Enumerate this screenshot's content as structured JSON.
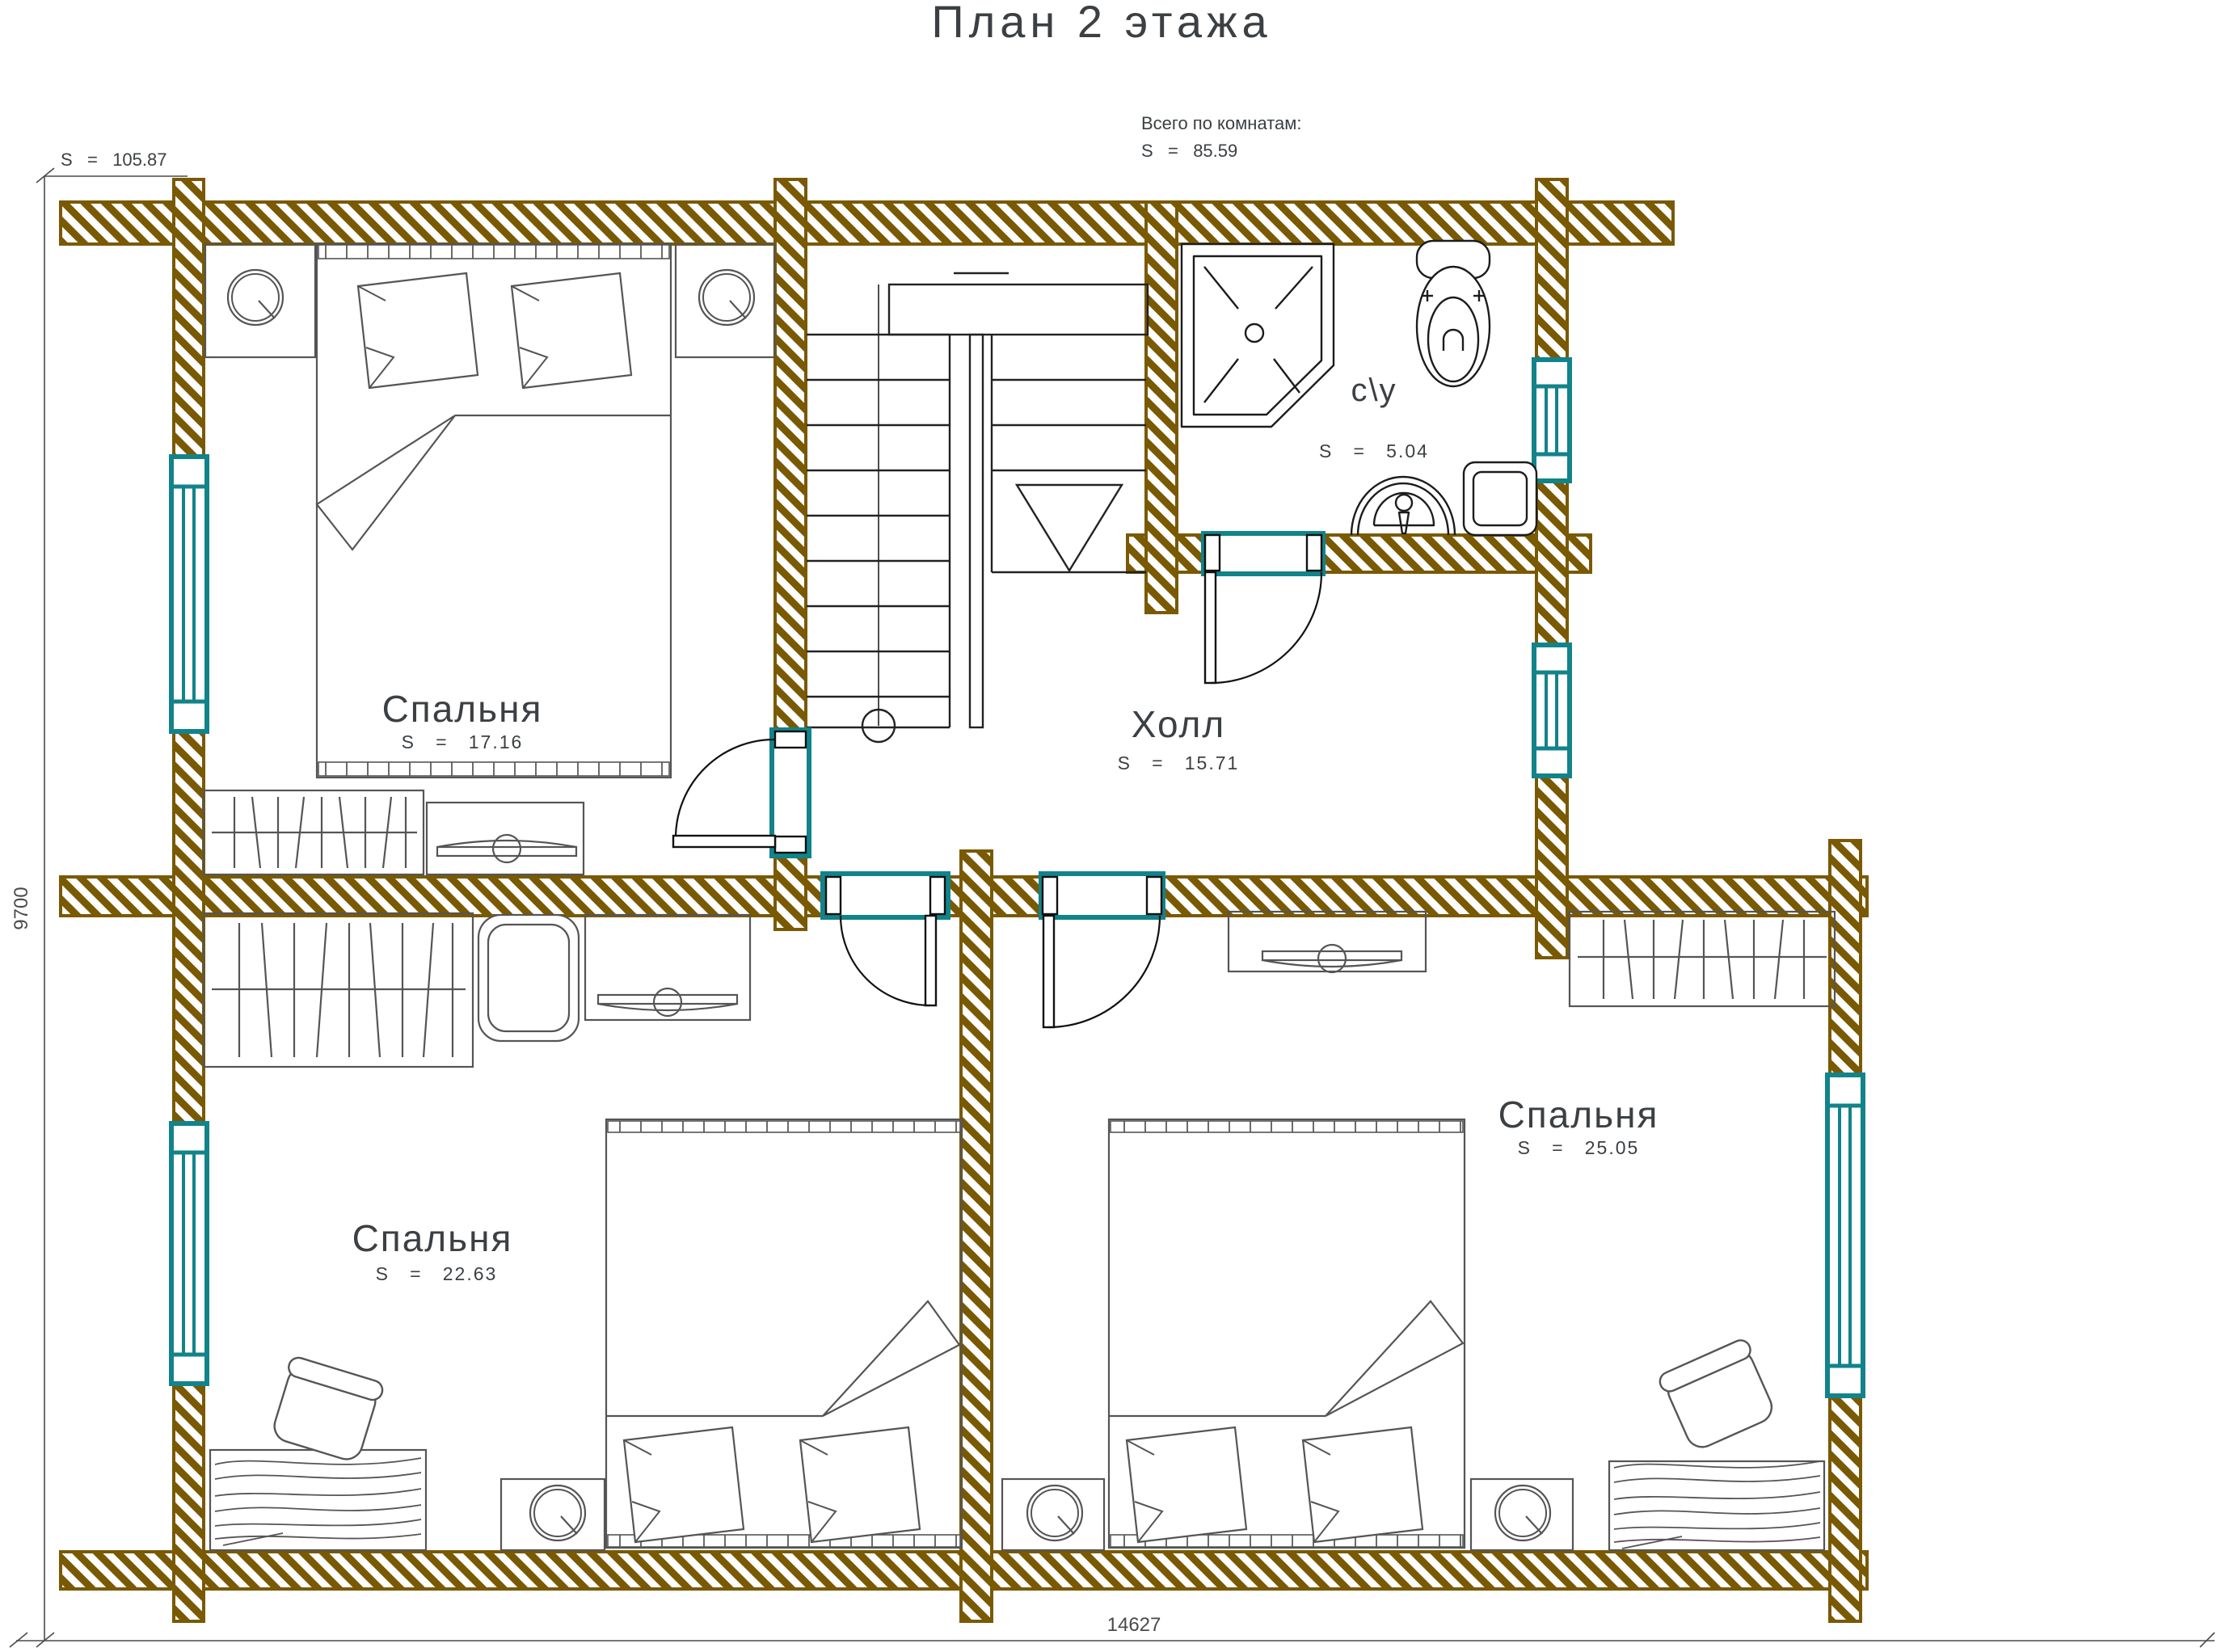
{
  "header": {
    "title": "План 2 этажа",
    "total_area": "S   =   105.87",
    "note_label": "Всего по комнатам:",
    "note_area": "S   =   85.59"
  },
  "rooms": [
    {
      "id": "bedroom-top-left",
      "name": "Спальня",
      "area": "S   =   17.16"
    },
    {
      "id": "hall",
      "name": "Холл",
      "area": "S   =   15.71"
    },
    {
      "id": "bathroom",
      "name": "с\\у",
      "area": "S   =   5.04"
    },
    {
      "id": "bedroom-bottom-left",
      "name": "Спальня",
      "area": "S   =   22.63"
    },
    {
      "id": "bedroom-bottom-right",
      "name": "Спальня",
      "area": "S   =   25.05"
    }
  ],
  "dimensions": {
    "height_mm": "9700",
    "width_mm": "14627"
  },
  "colors": {
    "wall_log_brown": "#7a5903",
    "window_door_teal": "#12838a",
    "drawing_black": "#1c1c1c",
    "furniture_gray": "#555555",
    "text_dark": "#3c4043"
  },
  "fixtures": {
    "bathroom": [
      "shower-cabin",
      "toilet",
      "sink",
      "washing-machine"
    ],
    "furniture": [
      "double-bed",
      "pillow",
      "nightstand",
      "table-lamp",
      "wardrobe",
      "tv-stand",
      "armchair",
      "desk",
      "desk-chair"
    ],
    "circulation": [
      "u-shaped-staircase",
      "door-swing",
      "window"
    ]
  }
}
